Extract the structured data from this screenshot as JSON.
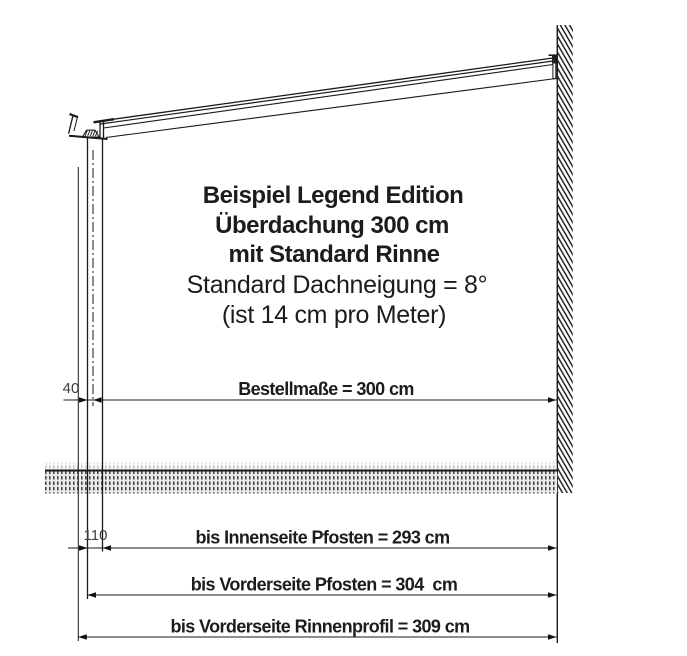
{
  "title_block": {
    "line1": "Beispiel Legend Edition",
    "line2": "Überdachung 300 cm",
    "line3": "mit Standard Rinne",
    "line4": "Standard Dachneigung = 8°",
    "line5": "(ist 14 cm pro Meter)"
  },
  "dimensions": {
    "bestellmass_label": "Bestellmaße = 300 cm",
    "post_offset_label": "40",
    "post_width_label": "110",
    "inner_post_label": "bis Innenseite Pfosten = 293 cm",
    "front_post_label": "bis Vorderseite Pfosten = 304  cm",
    "gutter_front_label": "bis Vorderseite Rinnenprofil = 309 cm"
  },
  "colors": {
    "line": "#1a1a1a",
    "text": "#1c1c1c",
    "dim_text": "#3d3d3d",
    "background": "#ffffff"
  }
}
